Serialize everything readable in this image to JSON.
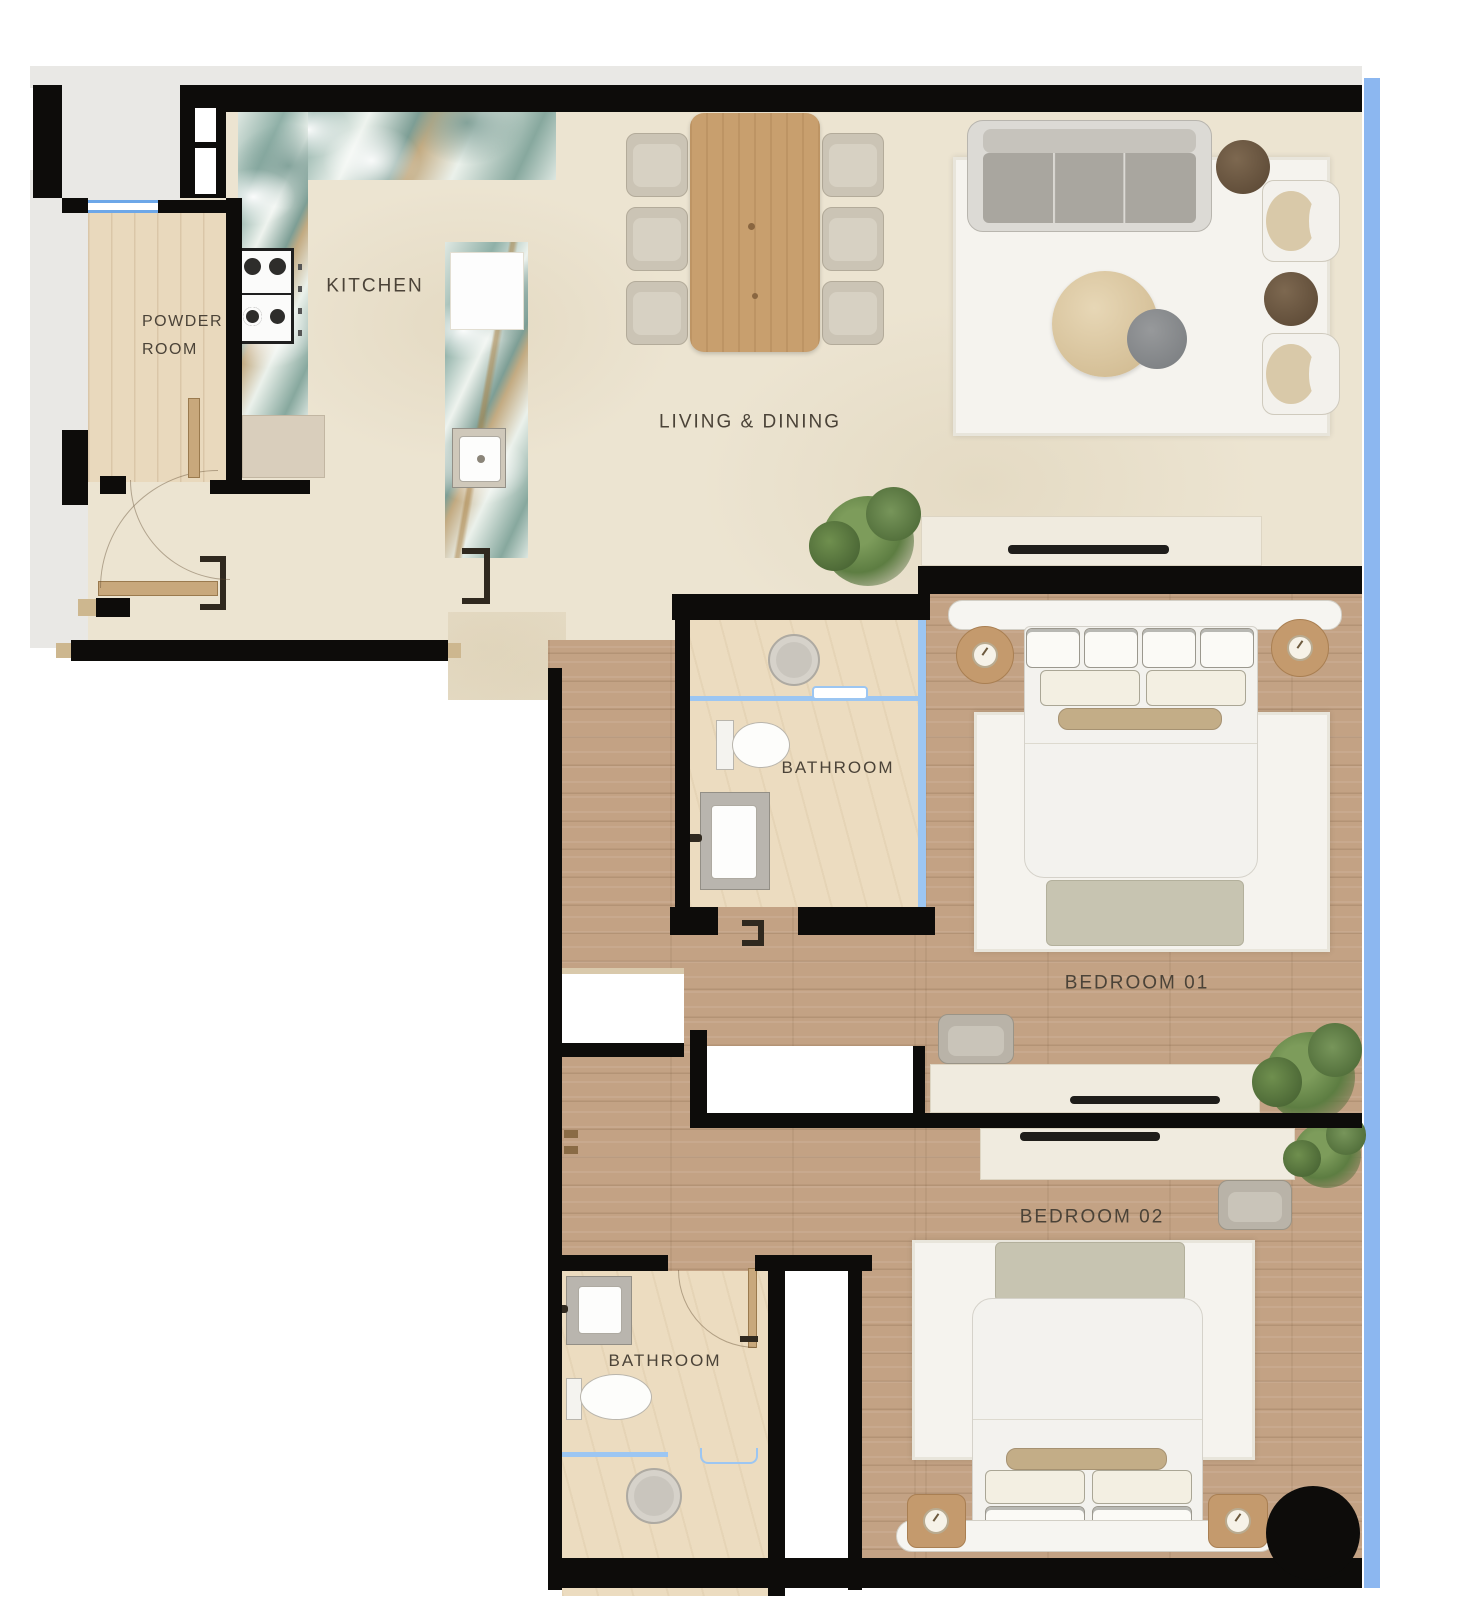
{
  "labels": {
    "kitchen": "KITCHEN",
    "powder_room_line1": "POWDER",
    "powder_room_line2": "ROOM",
    "living_dining": "LIVING & DINING",
    "bathroom_1": "BATHROOM",
    "bedroom_1": "BEDROOM 01",
    "bedroom_2": "BEDROOM 02",
    "bathroom_2": "BATHROOM"
  },
  "colors": {
    "wall": "#0d0c0a",
    "glass_balcony_blue": "#8cb7f0",
    "floor_main_beige": "#ece4d1",
    "floor_wood": "#c3a284",
    "floor_bathroom": "#ecdcc0",
    "outside_gray": "#e9e8e5",
    "rug_white": "#f5f3ee",
    "marble_teal": "#8fb0a7",
    "dining_table_wood": "#c89f6e",
    "side_table_dark_wood": "#6e5a42",
    "sage_bench": "#c7c4b1",
    "nightstand_tan": "#c49a6d",
    "label_text": "#4b4338"
  },
  "rooms": [
    {
      "id": "powder-room",
      "label": "POWDER ROOM"
    },
    {
      "id": "kitchen",
      "label": "KITCHEN"
    },
    {
      "id": "living-dining",
      "label": "LIVING & DINING"
    },
    {
      "id": "bathroom-1",
      "label": "BATHROOM"
    },
    {
      "id": "bedroom-1",
      "label": "BEDROOM 01"
    },
    {
      "id": "bedroom-2",
      "label": "BEDROOM 02"
    },
    {
      "id": "bathroom-2",
      "label": "BATHROOM"
    }
  ]
}
